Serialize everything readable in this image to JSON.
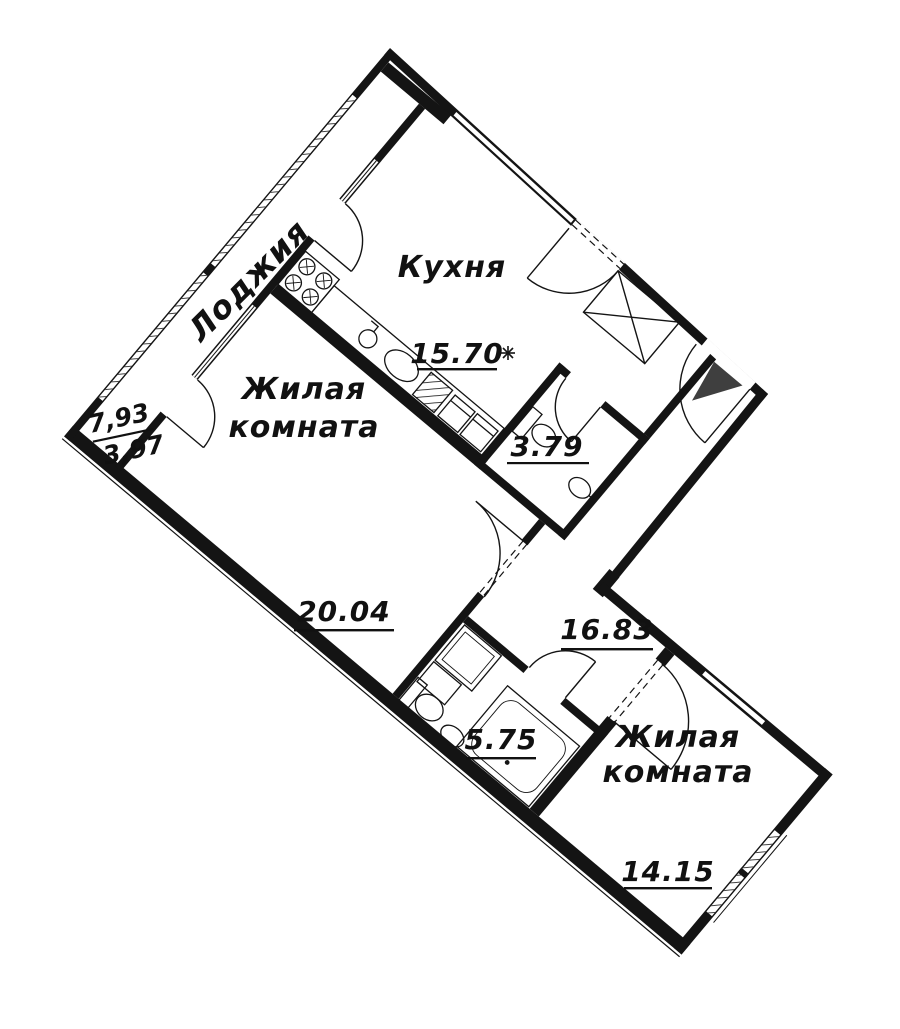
{
  "plan": {
    "type": "apartment-floor-plan",
    "rooms": {
      "loggia": {
        "name": "Лоджия",
        "area_full": "7,93",
        "area_reduced": "3,97"
      },
      "kitchen": {
        "name": "Кухня",
        "area": "15.70"
      },
      "living1": {
        "name_line1": "Жилая",
        "name_line2": "комната",
        "area": "20.04"
      },
      "wc": {
        "area": "3.79"
      },
      "hall": {
        "area": "16.83"
      },
      "bath": {
        "area": "5.75"
      },
      "living2": {
        "name_line1": "Жилая",
        "name_line2": "комната",
        "area": "14.15"
      }
    },
    "symbols": {
      "star": "✳",
      "entrance_marker": "triangle"
    },
    "colors": {
      "line": "#141414",
      "background": "#ffffff",
      "entrance_triangle": "#3f3f3f"
    }
  }
}
